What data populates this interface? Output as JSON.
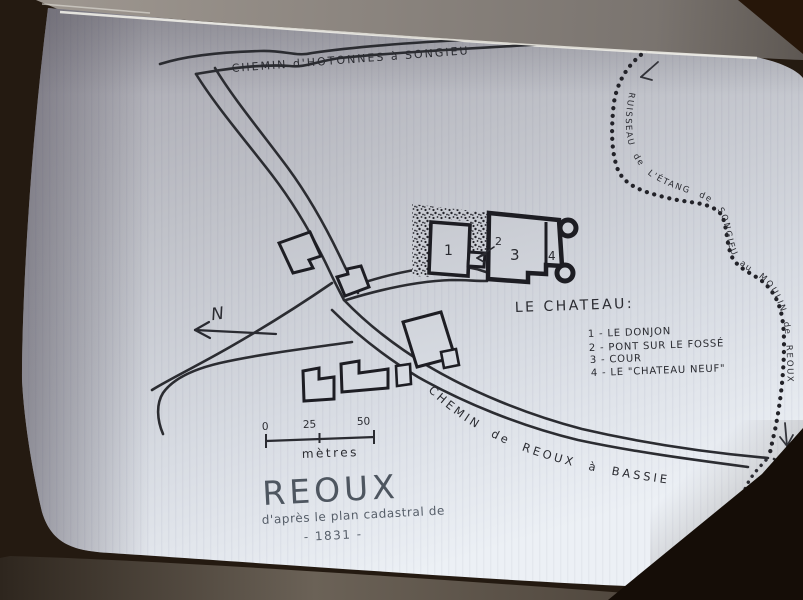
{
  "scene": {
    "description": "Photo of an open book page bearing a hand-drawn cadastral map",
    "colors": {
      "ink": "#26262c",
      "title_ink": "#4e5660",
      "page_light": "#ecf0f5",
      "page_dark": "#a7a6ae",
      "table_wood": "#60574d",
      "shadow_wood": "#241a11"
    }
  },
  "map": {
    "title": "REOUX",
    "subtitle": "d'après le plan cadastral de",
    "year": "- 1831 -",
    "north_label": "N",
    "roads": {
      "top": "CHEMIN d'HOTONNES à SONGIEU",
      "southeast": "CHEMIN de REOUX à BASSIEU"
    },
    "stream_label": "RUISSEAU de L'ÉTANG de SONGIEU au MOULIN de REOUX",
    "chateau": {
      "heading": "LE CHATEAU:",
      "markers": {
        "n1": "1",
        "n2": "2",
        "n3": "3",
        "n4": "4"
      },
      "legend": [
        "1 - LE DONJON",
        "2 - PONT SUR LE FOSSÉ",
        "3 - COUR",
        "4 - LE \"CHATEAU NEUF\""
      ]
    },
    "scale": {
      "ticks": [
        "0",
        "25",
        "50"
      ],
      "unit": "mètres"
    }
  }
}
